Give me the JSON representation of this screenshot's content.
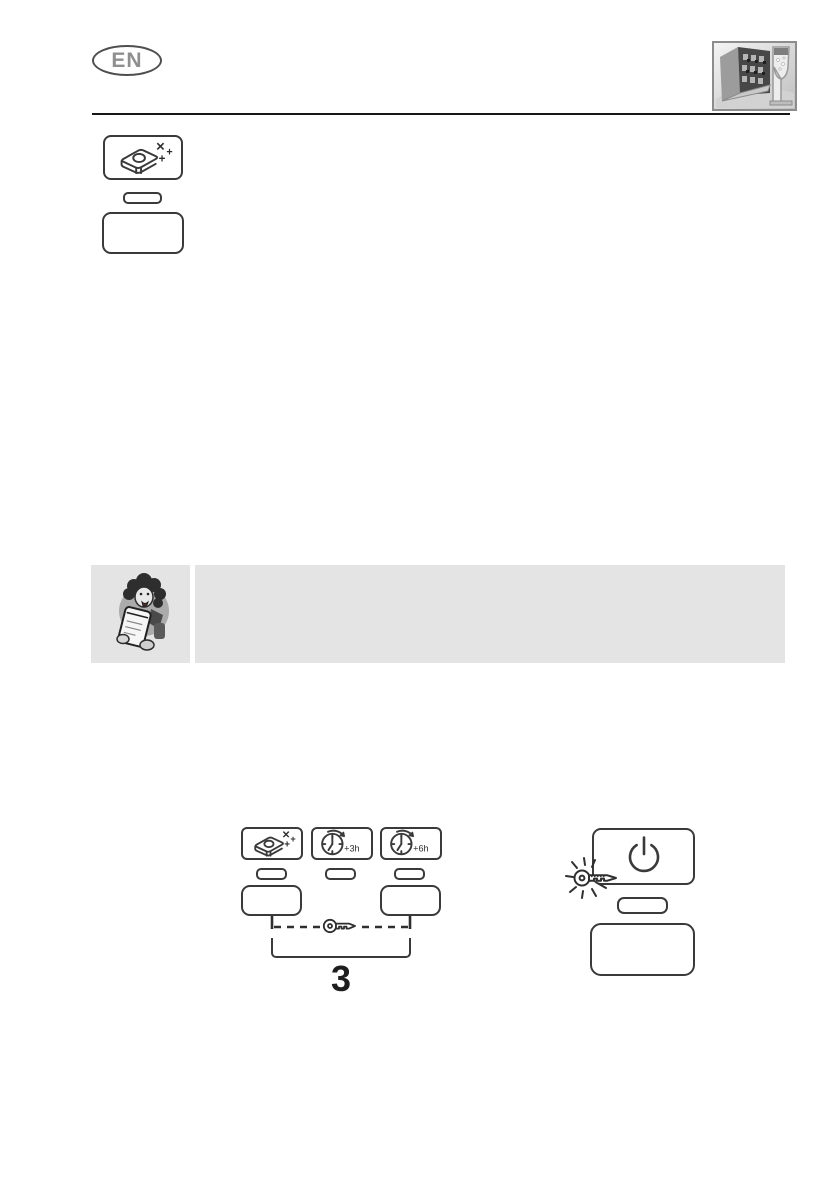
{
  "header": {
    "language_badge": "EN",
    "photo_icon": "dishwasher-with-champagne-glass-photo"
  },
  "legend": {
    "option": {
      "icon": "detergent-tablet-sparkle-icon",
      "indicator": "option-led",
      "button": "option-button"
    }
  },
  "note": {
    "icon": "assistant-woman-notepad-illustration",
    "text": ""
  },
  "panel_diagram": {
    "options": [
      {
        "icon": "detergent-tablet-sparkle-icon",
        "label": ""
      },
      {
        "icon": "clock-delay-icon",
        "label": "+3h"
      },
      {
        "icon": "clock-delay-icon",
        "label": "+6h"
      }
    ],
    "link": {
      "icon": "key-icon",
      "style": "dashed"
    },
    "bracket_label": "3"
  },
  "power_diagram": {
    "power_icon": "power-icon",
    "key_icon": "key-shine-icon",
    "indicator": "power-led",
    "button": "power-button"
  },
  "colors": {
    "line_art": "#3a3a3a",
    "note_background": "#e4e4e4",
    "badge_text": "#8f8f8f",
    "header_rule": "#161616"
  }
}
